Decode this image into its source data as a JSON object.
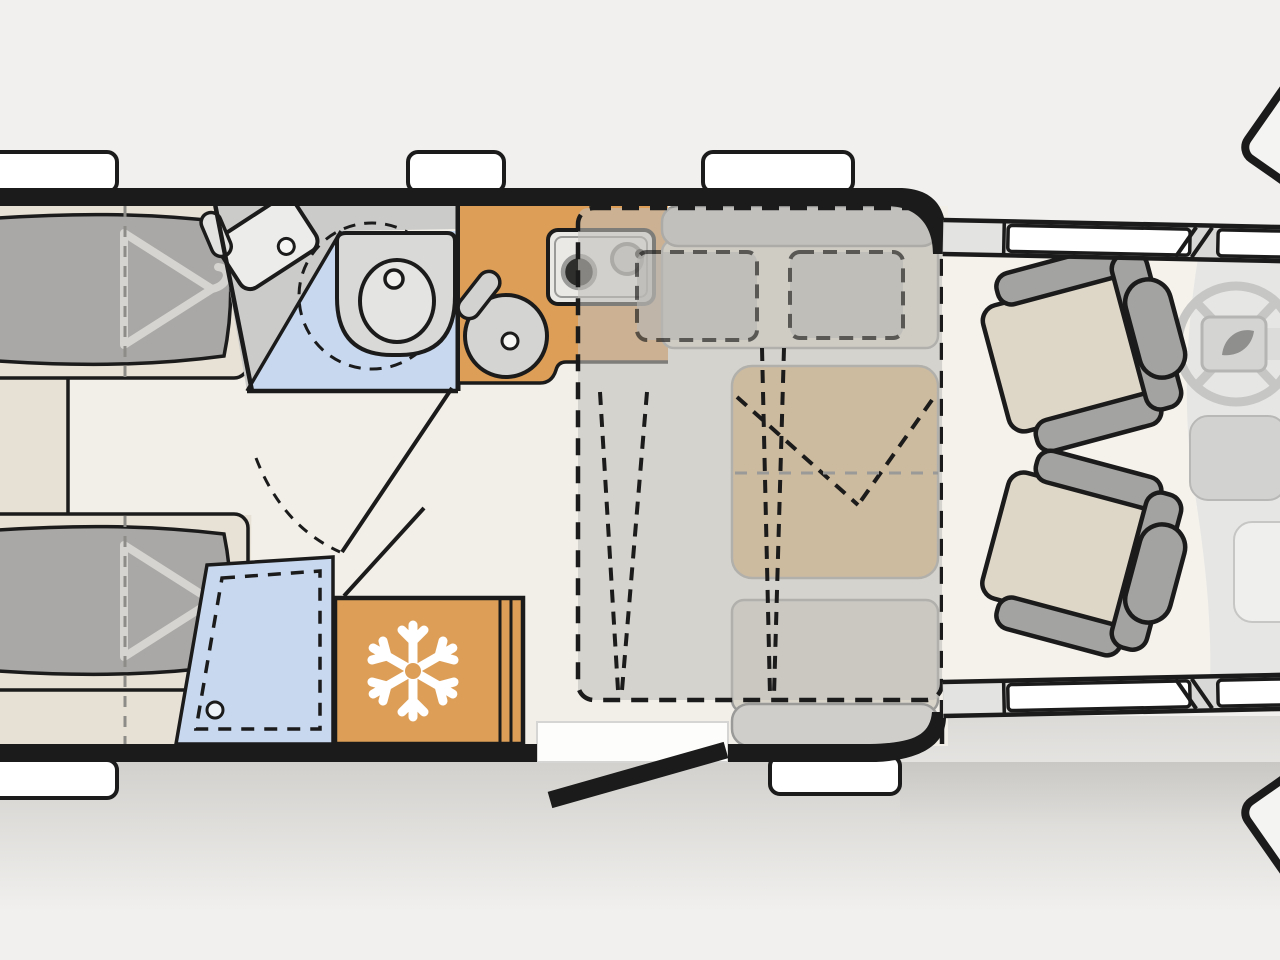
{
  "colors": {
    "bg": "#f1f0ee",
    "wall": "#1b1b1b",
    "floor": "#f2efe8",
    "floor-bedroom": "#e7e0d4",
    "floor-cab": "#f5f2ec",
    "window": "#ffffff",
    "bath-counter": "#cbcbc9",
    "bath-floor": "#c8d9ef",
    "fixture": "#d9d9d7",
    "kitchen": "#dd9f58",
    "stove": "#eae9e6",
    "bench-back": "#c2c1bf",
    "bench-seat": "#e3ded3",
    "bench2-seat": "#d8d4ca",
    "bench2-back": "#cfcecb",
    "table": "#dfb377",
    "mattress": "#a9a8a6",
    "bed-base": "#e8e1d5",
    "hanger": "#d6d4d0",
    "overlay": "#c2bfba",
    "pillow": "#b9b7b4",
    "seat-cushion": "#ded6c7",
    "seat-gray": "#a3a3a1",
    "cab-wall": "#d8d8d6",
    "dash": "#e6e6e4",
    "console": "#d2d2d0",
    "wheel": "#c6c6c4",
    "snowflake": "#ffffff",
    "white": "#fdfdfc"
  },
  "floorplan": {
    "type": "motorhome-top-view-floorplan",
    "rooms": [
      {
        "id": "rear-bedroom",
        "features": [
          "twin-bed-top",
          "twin-bed-bottom",
          "hanger-icon-x2",
          "center-step"
        ]
      },
      {
        "id": "bathroom",
        "features": [
          "washbasin",
          "swivel-toilet",
          "door-swing"
        ]
      },
      {
        "id": "shower",
        "features": [
          "shower-tray-dashed",
          "drain"
        ]
      },
      {
        "id": "kitchen",
        "features": [
          "round-sink",
          "two-burner-stove",
          "counter"
        ]
      },
      {
        "id": "refrigerator",
        "features": [
          "snowflake-icon"
        ]
      },
      {
        "id": "dinette",
        "features": [
          "front-bench",
          "rear-bench",
          "table",
          "drop-down-bed-dashed",
          "pillows-x2"
        ]
      },
      {
        "id": "entry",
        "features": [
          "open-door",
          "step"
        ]
      },
      {
        "id": "cab",
        "features": [
          "driver-seat",
          "passenger-seat",
          "steering-wheel",
          "dethleffs-leaf-logo",
          "dashboard",
          "side-mirrors",
          "cab-windows"
        ]
      }
    ],
    "windows": {
      "top_wall": 3,
      "bottom_wall": 2,
      "cab_side_each": 2
    }
  }
}
